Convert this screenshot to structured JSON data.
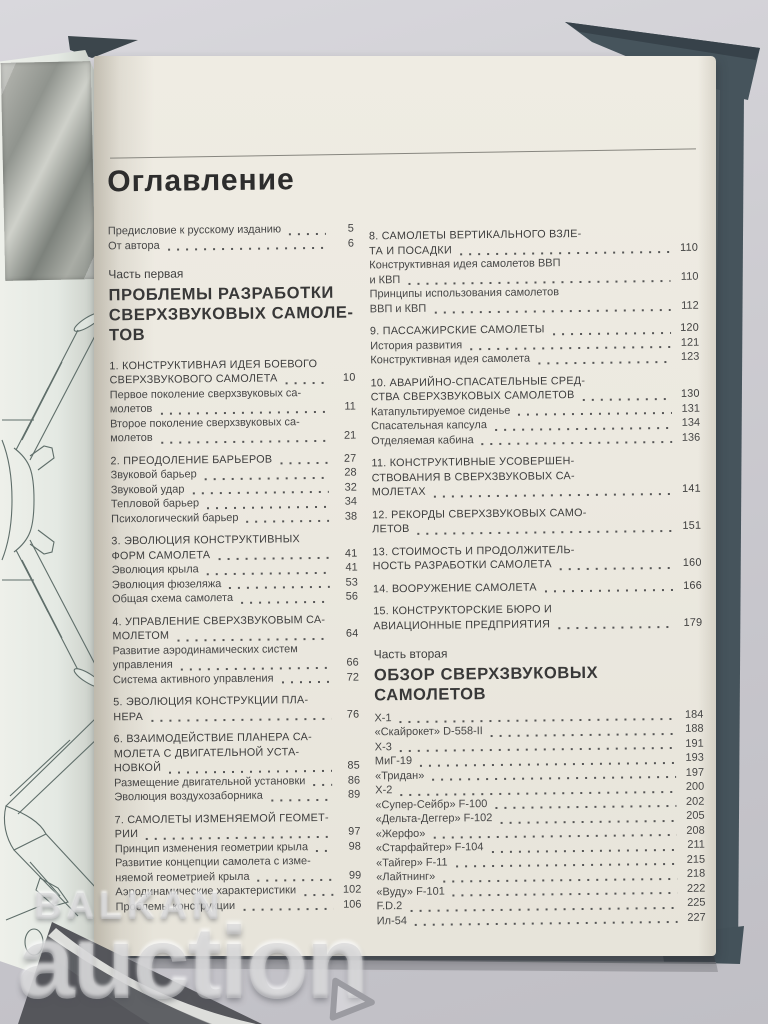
{
  "toc": {
    "title": "Оглавление",
    "columns": {
      "left": [
        {
          "kind": "sub",
          "lines": [
            "Предисловие к русскому изданию"
          ],
          "page": "5"
        },
        {
          "kind": "sub",
          "lines": [
            "От автора"
          ],
          "page": "6"
        },
        {
          "kind": "part-label",
          "lines": [
            "Часть первая"
          ]
        },
        {
          "kind": "part-title",
          "lines": [
            "ПРОБЛЕМЫ РАЗРАБОТКИ",
            "СВЕРХЗВУКОВЫХ САМОЛЕ-",
            "ТОВ"
          ]
        },
        {
          "kind": "chapter",
          "lines": [
            "1. КОНСТРУКТИВНАЯ ИДЕЯ БОЕВОГО",
            "СВЕРХЗВУКОВОГО САМОЛЕТА"
          ],
          "page": "10"
        },
        {
          "kind": "sub",
          "lines": [
            "Первое поколение сверхзвуковых са-",
            "молетов"
          ],
          "page": "11"
        },
        {
          "kind": "sub",
          "lines": [
            "Второе поколение сверхзвуковых са-",
            "молетов"
          ],
          "page": "21"
        },
        {
          "kind": "chapter",
          "lines": [
            "2. ПРЕОДОЛЕНИЕ БАРЬЕРОВ"
          ],
          "page": "27"
        },
        {
          "kind": "sub",
          "lines": [
            "Звуковой барьер"
          ],
          "page": "28"
        },
        {
          "kind": "sub",
          "lines": [
            "Звуковой удар"
          ],
          "page": "32"
        },
        {
          "kind": "sub",
          "lines": [
            "Тепловой барьер"
          ],
          "page": "34"
        },
        {
          "kind": "sub",
          "lines": [
            "Психологический барьер"
          ],
          "page": "38"
        },
        {
          "kind": "chapter",
          "lines": [
            "3. ЭВОЛЮЦИЯ КОНСТРУКТИВНЫХ",
            "ФОРМ САМОЛЕТА"
          ],
          "page": "41"
        },
        {
          "kind": "sub",
          "lines": [
            "Эволюция крыла"
          ],
          "page": "41"
        },
        {
          "kind": "sub",
          "lines": [
            "Эволюция фюзеляжа"
          ],
          "page": "53"
        },
        {
          "kind": "sub",
          "lines": [
            "Общая схема самолета"
          ],
          "page": "56"
        },
        {
          "kind": "chapter",
          "lines": [
            "4. УПРАВЛЕНИЕ СВЕРХЗВУКОВЫМ СА-",
            "МОЛЕТОМ"
          ],
          "page": "64"
        },
        {
          "kind": "sub",
          "lines": [
            "Развитие аэродинамических систем",
            "управления"
          ],
          "page": "66"
        },
        {
          "kind": "sub",
          "lines": [
            "Система активного управления"
          ],
          "page": "72"
        },
        {
          "kind": "chapter",
          "lines": [
            "5. ЭВОЛЮЦИЯ КОНСТРУКЦИИ ПЛА-",
            "НЕРА"
          ],
          "page": "76"
        },
        {
          "kind": "chapter",
          "lines": [
            "6. ВЗАИМОДЕЙСТВИЕ ПЛАНЕРА СА-",
            "МОЛЕТА С ДВИГАТЕЛЬНОЙ УСТА-",
            "НОВКОЙ"
          ],
          "page": "85"
        },
        {
          "kind": "sub",
          "lines": [
            "Размещение двигательной установки"
          ],
          "page": "86"
        },
        {
          "kind": "sub",
          "lines": [
            "Эволюция воздухозаборника"
          ],
          "page": "89"
        },
        {
          "kind": "chapter",
          "lines": [
            "7. САМОЛЕТЫ ИЗМЕНЯЕМОЙ ГЕОМЕТ-",
            "РИИ"
          ],
          "page": "97"
        },
        {
          "kind": "sub",
          "lines": [
            "Принцип изменения геометрии крыла"
          ],
          "page": "98"
        },
        {
          "kind": "sub",
          "lines": [
            "Развитие концепции самолета с изме-",
            "няемой геометрией крыла"
          ],
          "page": "99"
        },
        {
          "kind": "sub",
          "lines": [
            "Аэродинамические характеристики"
          ],
          "page": "102"
        },
        {
          "kind": "sub",
          "lines": [
            "Проблемы конструкции"
          ],
          "page": "106"
        }
      ],
      "right": [
        {
          "kind": "chapter",
          "lines": [
            "8. САМОЛЕТЫ ВЕРТИКАЛЬНОГО ВЗЛЕ-",
            "ТА И ПОСАДКИ"
          ],
          "page": "110"
        },
        {
          "kind": "sub",
          "lines": [
            "Конструктивная идея самолетов ВВП",
            "и КВП"
          ],
          "page": "110"
        },
        {
          "kind": "sub",
          "lines": [
            "Принципы использования самолетов",
            "ВВП и КВП"
          ],
          "page": "112"
        },
        {
          "kind": "chapter",
          "lines": [
            "9. ПАССАЖИРСКИЕ САМОЛЕТЫ"
          ],
          "page": "120"
        },
        {
          "kind": "sub",
          "lines": [
            "История развития"
          ],
          "page": "121"
        },
        {
          "kind": "sub",
          "lines": [
            "Конструктивная идея самолета"
          ],
          "page": "123"
        },
        {
          "kind": "chapter",
          "lines": [
            "10. АВАРИЙНО-СПАСАТЕЛЬНЫЕ СРЕД-",
            "СТВА СВЕРХЗВУКОВЫХ САМОЛЕТОВ"
          ],
          "page": "130"
        },
        {
          "kind": "sub",
          "lines": [
            "Катапультируемое сиденье"
          ],
          "page": "131"
        },
        {
          "kind": "sub",
          "lines": [
            "Спасательная капсула"
          ],
          "page": "134"
        },
        {
          "kind": "sub",
          "lines": [
            "Отделяемая кабина"
          ],
          "page": "136"
        },
        {
          "kind": "chapter",
          "lines": [
            "11. КОНСТРУКТИВНЫЕ  УСОВЕРШЕН-",
            "СТВОВАНИЯ В СВЕРХЗВУКОВЫХ СА-",
            "МОЛЕТАХ"
          ],
          "page": "141"
        },
        {
          "kind": "chapter",
          "lines": [
            "12. РЕКОРДЫ СВЕРХЗВУКОВЫХ САМО-",
            "ЛЕТОВ"
          ],
          "page": "151"
        },
        {
          "kind": "chapter",
          "lines": [
            "13. СТОИМОСТЬ И ПРОДОЛЖИТЕЛЬ-",
            "НОСТЬ РАЗРАБОТКИ САМОЛЕТА"
          ],
          "page": "160"
        },
        {
          "kind": "chapter",
          "lines": [
            "14. ВООРУЖЕНИЕ САМОЛЕТА"
          ],
          "page": "166"
        },
        {
          "kind": "chapter",
          "lines": [
            "15. КОНСТРУКТОРСКИЕ БЮРО И",
            "АВИАЦИОННЫЕ ПРЕДПРИЯТИЯ"
          ],
          "page": "179"
        },
        {
          "kind": "part-label",
          "lines": [
            "Часть вторая"
          ]
        },
        {
          "kind": "part-title",
          "lines": [
            "ОБЗОР СВЕРХЗВУКОВЫХ",
            "САМОЛЕТОВ"
          ]
        },
        {
          "kind": "sub",
          "lines": [
            "X-1"
          ],
          "page": "184"
        },
        {
          "kind": "sub",
          "lines": [
            "«Скайрокет» D-558-II"
          ],
          "page": "188"
        },
        {
          "kind": "sub",
          "lines": [
            "X-3"
          ],
          "page": "191"
        },
        {
          "kind": "sub",
          "lines": [
            "МиГ-19"
          ],
          "page": "193"
        },
        {
          "kind": "sub",
          "lines": [
            "«Тридан»"
          ],
          "page": "197"
        },
        {
          "kind": "sub",
          "lines": [
            "X-2"
          ],
          "page": "200"
        },
        {
          "kind": "sub",
          "lines": [
            "«Супер-Сейбр» F-100"
          ],
          "page": "202"
        },
        {
          "kind": "sub",
          "lines": [
            "«Дельта-Деггер» F-102"
          ],
          "page": "205"
        },
        {
          "kind": "sub",
          "lines": [
            "«Жерфо»"
          ],
          "page": "208"
        },
        {
          "kind": "sub",
          "lines": [
            "«Старфайтер» F-104"
          ],
          "page": "211"
        },
        {
          "kind": "sub",
          "lines": [
            "«Тайгер» F-11"
          ],
          "page": "215"
        },
        {
          "kind": "sub",
          "lines": [
            "«Лайтнинг»"
          ],
          "page": "218"
        },
        {
          "kind": "sub",
          "lines": [
            "«Вуду» F-101"
          ],
          "page": "222"
        },
        {
          "kind": "sub",
          "lines": [
            "F.D.2"
          ],
          "page": "225"
        },
        {
          "kind": "sub",
          "lines": [
            "Ил-54"
          ],
          "page": "227"
        }
      ]
    }
  },
  "watermark": {
    "line1": "BALKAN",
    "line2": "auction"
  },
  "colors": {
    "cover": "#46545c",
    "cover_dark": "#37424a",
    "page": "#ece9e0",
    "left_page": "#e4e9e3",
    "text": "#434343",
    "background": "#cecdd2"
  }
}
